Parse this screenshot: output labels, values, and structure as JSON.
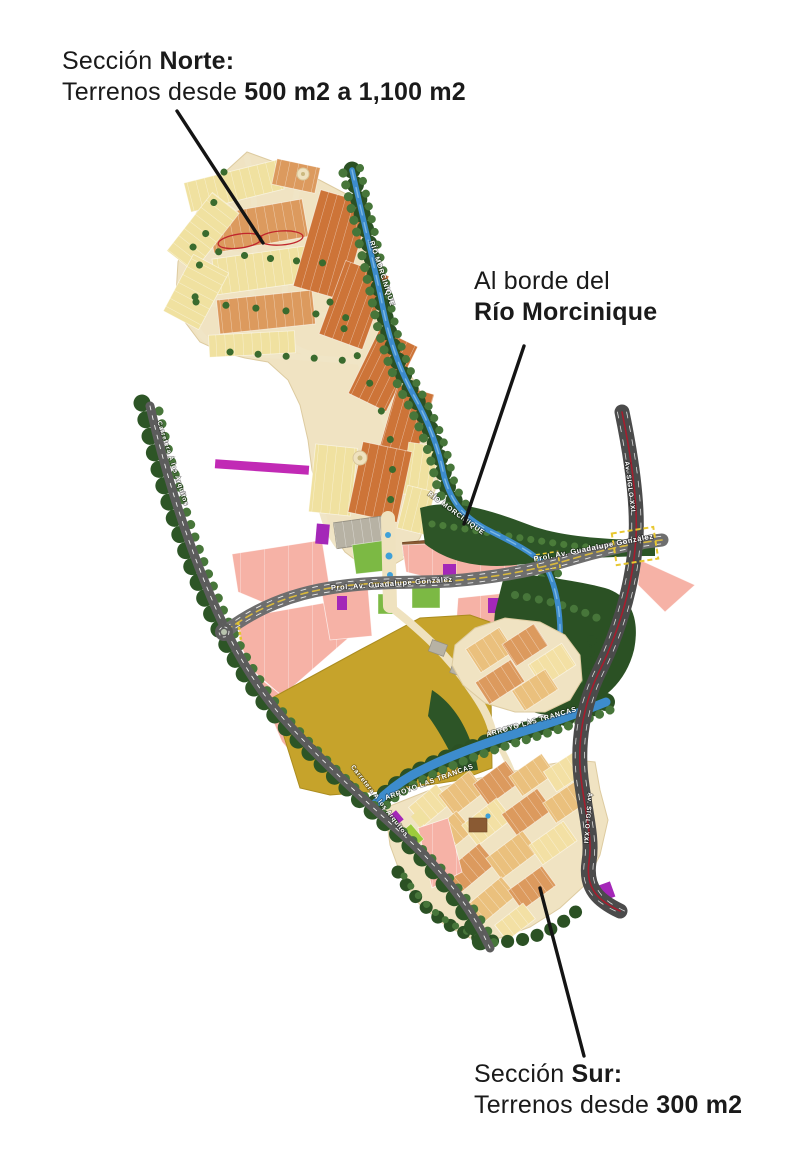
{
  "annotations": {
    "norte": {
      "prefix": "Sección ",
      "bold": "Norte:",
      "line2_prefix": "Terrenos desde ",
      "line2_bold": "500 m2 a 1,100 m2"
    },
    "rio": {
      "line1": "Al borde del",
      "line2": "Río Morcinique"
    },
    "sur": {
      "prefix": "Sección ",
      "bold": "Sur:",
      "line2_prefix": "Terrenos desde ",
      "line2_bold": "300 m2"
    }
  },
  "map_labels": {
    "carretera": "Carretera A los Arquitos",
    "prol_av": "Prol. Av. Guadalupe González",
    "siglo": "Av. SIGLO XXI",
    "arroyo": "ARROYO LAS TRANCAS",
    "rio": "RÍO MORCINIQUE"
  },
  "colors": {
    "lot_yellow": "#f0e1a0",
    "lot_orange": "#cd7438",
    "lot_orange_light": "#dc9a5e",
    "lot_tan": "#eac07d",
    "lot_cream": "#f3e0a4",
    "parcel_pink": "#f6b2a6",
    "parcel_green": "#7cb944",
    "parcel_purple": "#a427b8",
    "parcel_mustard": "#c6a32b",
    "river_blue": "#3d8ccd",
    "road_gray": "#6e6e6e",
    "road_dark": "#4b4b4b",
    "road_red_line": "#a61e2e",
    "tree_dark": "#2b5124",
    "tree_light": "#47763a",
    "accent_magenta": "#c12ab5",
    "highlight_red": "#c0262c",
    "text_dark": "#1a1a1a"
  }
}
